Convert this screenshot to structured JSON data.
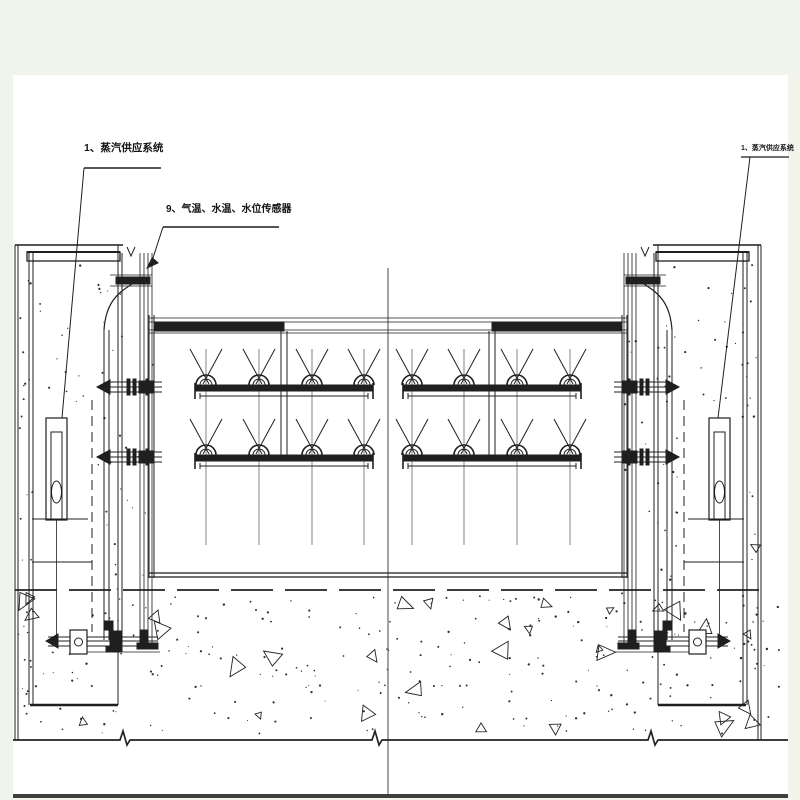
{
  "page": {
    "background": "#f1f4ea",
    "paper": "#ffffff",
    "ink": "#1f1f1f",
    "gray_line": "#4f4f4f"
  },
  "annotations": {
    "steam_supply_left": "1、蒸汽供应系统",
    "sensors": "9、气温、水温、水位传感器",
    "steam_supply_right": "1、蒸汽供应系统"
  }
}
